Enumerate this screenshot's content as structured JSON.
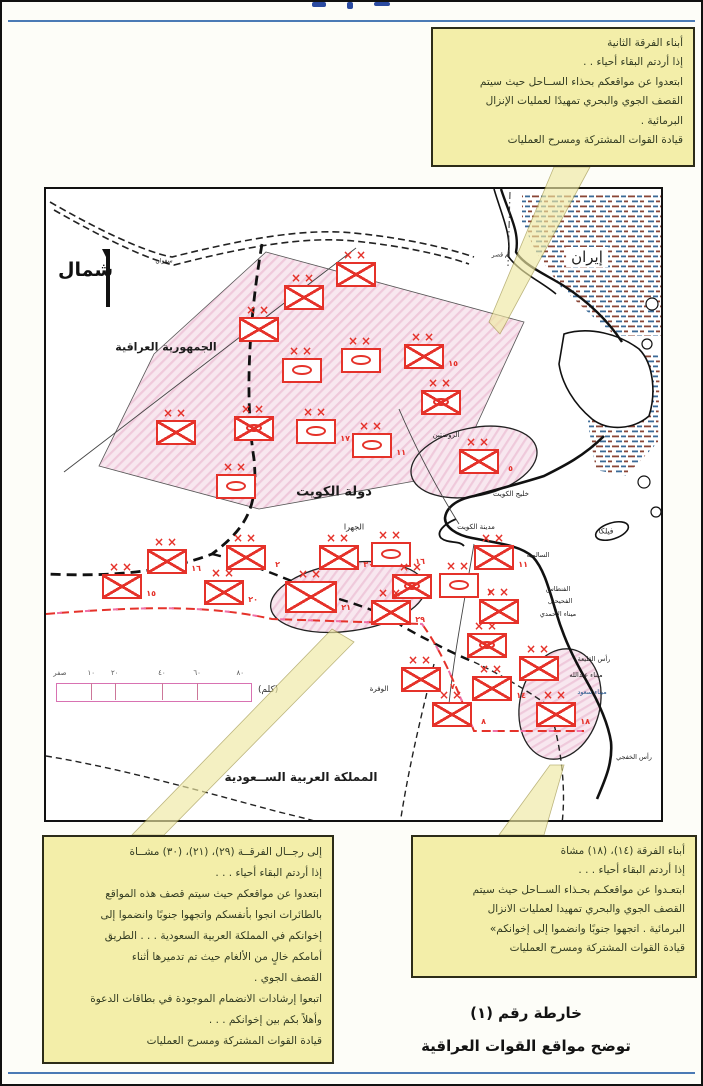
{
  "colors": {
    "accent_red": "#e5322a",
    "callout_bg": "#f3eea9",
    "band_yellow": "#efe9a2",
    "rule_blue": "#4a7ab5",
    "zone_pink": "#f3d7e6"
  },
  "caption": {
    "line1": "خارطة رقم (١)",
    "line2": "توضح مواقع القوات العراقية"
  },
  "callouts": {
    "top": {
      "lines": [
        "أبناء الفرقة الثانية",
        "إذا أردتم البقاء أحياء . .",
        "ابتعدوا عن مواقعكم بحذاء الســاحل حيث سيتم",
        "القصف الجوي والبحري تمهيدًا لعمليات الإنزال",
        "البرمائية .",
        "قيادة القوات المشتركة ومسرح العمليات"
      ]
    },
    "bottom_left": {
      "lines": [
        "إلى رجــال الفرقــة (٢٩)، (٢١)، (٣٠) مشــاة",
        "إذا أردتم البقاء أحياء . . .",
        "ابتعدوا عن مواقعكم حيث سيتم قصف هذه المواقع",
        "بالطائرات انجوا بأنفسكم واتجهوا جنوبًا وانضموا إلى",
        "إخوانكم في المملكة العربية السعودية . . . الطريق",
        "أمامكم خالٍ من الألغام حيث تم تدميرها أثناء",
        "القصف الجوي .",
        "اتبعوا إرشادات الانضمام الموجودة في بطاقات الدعوة",
        "وأهلاً بكم بين إخوانكم . . .",
        "قيادة القوات المشتركة ومسرح العمليات"
      ]
    },
    "bottom_right": {
      "lines": [
        "أبناء الفرقة (١٤)، (١٨) مشاة",
        "إذا أردتم البقاء أحياء . . .",
        "ابتعـدوا عن مواقعكـم بحـذاء الســاحل حيث سيتم",
        "القصف الجوي والبحري تمهيدا لعمليات الانزال",
        "البرمائية . اتجهوا جنوبًا وانضموا إلى إخوانكم»",
        "قيادة القوات المشتركة ومسرح العمليات"
      ]
    }
  },
  "map": {
    "north_label": "شمال",
    "labels": [
      {
        "t": "الجمهورية العراقية",
        "x": 120,
        "y": 158,
        "s": 11,
        "b": 1
      },
      {
        "t": "إيران",
        "x": 541,
        "y": 68,
        "s": 15,
        "bg": 1
      },
      {
        "t": "دولة الكويت",
        "x": 288,
        "y": 303,
        "s": 13,
        "b": 1
      },
      {
        "t": "المملكة العربية الســعودية",
        "x": 255,
        "y": 588,
        "s": 12,
        "b": 1
      },
      {
        "t": "الجهرا",
        "x": 308,
        "y": 338,
        "s": 8
      },
      {
        "t": "مدينة الكويت",
        "x": 430,
        "y": 338,
        "s": 7
      },
      {
        "t": "خليج الكويت",
        "x": 465,
        "y": 305,
        "s": 7
      },
      {
        "t": "الروضتين",
        "x": 400,
        "y": 246,
        "s": 7
      },
      {
        "t": "فيلكا",
        "x": 560,
        "y": 342,
        "s": 7.5
      },
      {
        "t": "السالمية",
        "x": 492,
        "y": 366,
        "s": 6.5
      },
      {
        "t": "الفنطاس",
        "x": 512,
        "y": 400,
        "s": 6.5
      },
      {
        "t": "الفحيحيل",
        "x": 514,
        "y": 412,
        "s": 6.5
      },
      {
        "t": "ميناء الأحمدي",
        "x": 512,
        "y": 425,
        "s": 6.5
      },
      {
        "t": "رأس القليعة",
        "x": 548,
        "y": 470,
        "s": 6.5
      },
      {
        "t": "ميناء عبدالله",
        "x": 540,
        "y": 486,
        "s": 6.5
      },
      {
        "t": "ميناء سعود",
        "x": 546,
        "y": 503,
        "s": 6.5,
        "c": "#2a5a8f"
      },
      {
        "t": "رأس الخفجي",
        "x": 588,
        "y": 568,
        "s": 6.5
      },
      {
        "t": "الوفرة",
        "x": 333,
        "y": 500,
        "s": 7
      },
      {
        "t": "سفوان",
        "x": 118,
        "y": 72,
        "s": 6
      },
      {
        "t": "أم قصر",
        "x": 455,
        "y": 66,
        "s": 6
      }
    ],
    "units": [
      {
        "type": "infantry",
        "x": 310,
        "y": 85,
        "num": ""
      },
      {
        "type": "infantry",
        "x": 258,
        "y": 108,
        "num": ""
      },
      {
        "type": "infantry",
        "x": 213,
        "y": 140,
        "num": ""
      },
      {
        "type": "armored",
        "x": 256,
        "y": 181,
        "num": ""
      },
      {
        "type": "armored",
        "x": 315,
        "y": 171,
        "num": ""
      },
      {
        "type": "infantry",
        "x": 378,
        "y": 167,
        "num": "١٥"
      },
      {
        "type": "mechanized",
        "x": 395,
        "y": 213,
        "num": ""
      },
      {
        "type": "infantry",
        "x": 130,
        "y": 243,
        "num": ""
      },
      {
        "type": "mechanized",
        "x": 208,
        "y": 239,
        "num": ""
      },
      {
        "type": "armored",
        "x": 270,
        "y": 242,
        "num": "١٧"
      },
      {
        "type": "armored",
        "x": 326,
        "y": 256,
        "num": "١١"
      },
      {
        "type": "armored",
        "x": 190,
        "y": 297,
        "num": ""
      },
      {
        "type": "infantry",
        "x": 433,
        "y": 272,
        "num": "٥"
      },
      {
        "type": "infantry",
        "x": 121,
        "y": 372,
        "num": "١٦"
      },
      {
        "type": "infantry",
        "x": 76,
        "y": 397,
        "num": "١٥"
      },
      {
        "type": "infantry",
        "x": 200,
        "y": 368,
        "num": "٢"
      },
      {
        "type": "infantry",
        "x": 178,
        "y": 403,
        "num": "٢٠"
      },
      {
        "type": "infantry",
        "x": 265,
        "y": 408,
        "num": "٢١",
        "big": true
      },
      {
        "type": "infantry",
        "x": 293,
        "y": 368,
        "num": "٣٠"
      },
      {
        "type": "armored",
        "x": 345,
        "y": 365,
        "num": "١٦"
      },
      {
        "type": "mechanized",
        "x": 366,
        "y": 397,
        "num": ""
      },
      {
        "type": "armored",
        "x": 413,
        "y": 396,
        "num": "٣"
      },
      {
        "type": "infantry",
        "x": 345,
        "y": 423,
        "num": "٢٩"
      },
      {
        "type": "infantry",
        "x": 448,
        "y": 368,
        "num": "١١"
      },
      {
        "type": "infantry",
        "x": 453,
        "y": 422,
        "num": ""
      },
      {
        "type": "mechanized",
        "x": 441,
        "y": 456,
        "num": ""
      },
      {
        "type": "infantry",
        "x": 493,
        "y": 479,
        "num": ""
      },
      {
        "type": "infantry",
        "x": 375,
        "y": 490,
        "num": "٧"
      },
      {
        "type": "infantry",
        "x": 446,
        "y": 499,
        "num": "١٤"
      },
      {
        "type": "infantry",
        "x": 406,
        "y": 525,
        "num": "٨"
      },
      {
        "type": "infantry",
        "x": 510,
        "y": 525,
        "num": "١٨"
      }
    ],
    "echelon_mark": "××",
    "scale": {
      "ticks": [
        "صفر",
        "١٠",
        "٢٠",
        "٤٠",
        "٦٠",
        "٨٠"
      ],
      "pos": [
        2,
        18,
        30,
        54,
        72,
        94
      ],
      "dividers": [
        18,
        30,
        54,
        72
      ],
      "unit": "(كلم)"
    }
  }
}
